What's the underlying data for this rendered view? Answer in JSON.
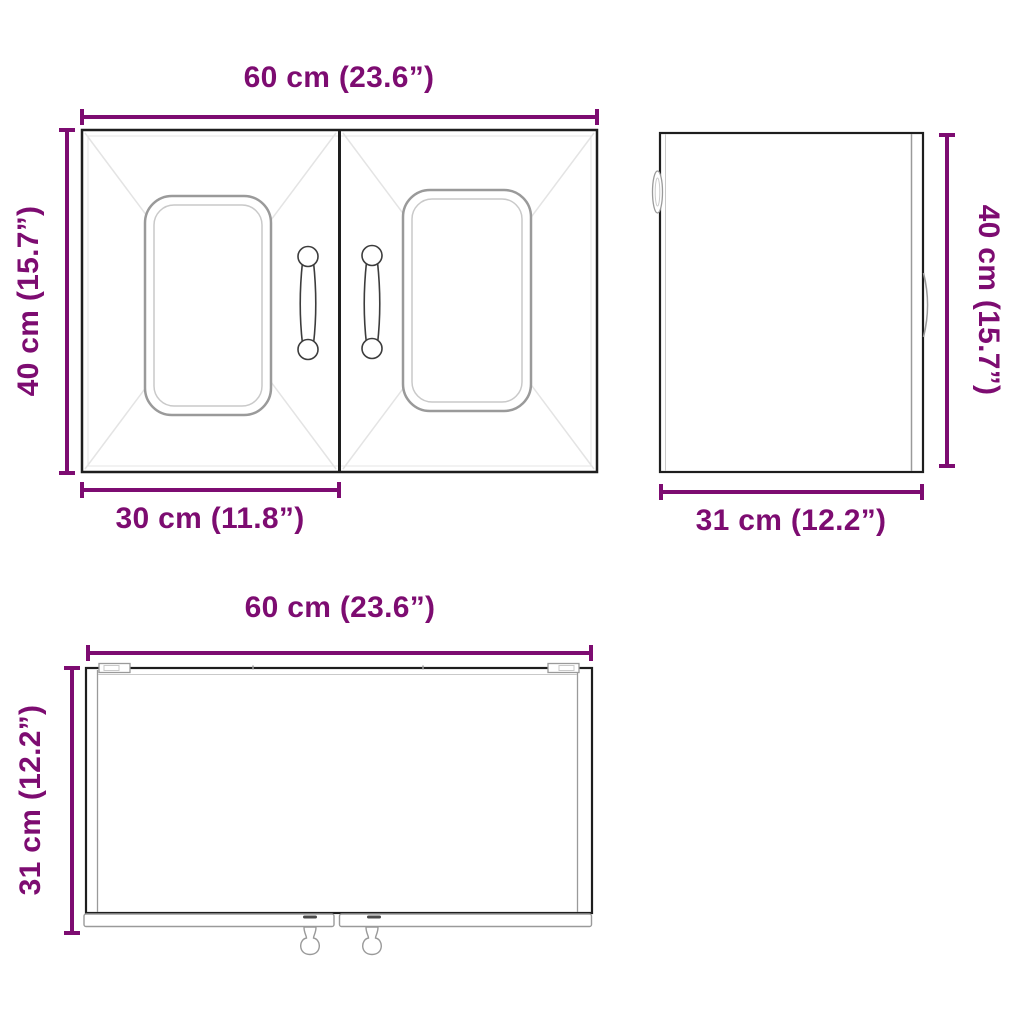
{
  "colors": {
    "dimension": "#7d0c71",
    "outline": "#1e1e1e",
    "detail": "#9a9a9a"
  },
  "views": {
    "front": {
      "width_label": "60 cm (23.6”)",
      "height_label": "40 cm (15.7”)",
      "door_width_label": "30 cm (11.8”)"
    },
    "side": {
      "height_label": "40 cm (15.7”)",
      "depth_label": "31 cm (12.2”)"
    },
    "top": {
      "width_label": "60 cm (23.6”)",
      "depth_label": "31 cm (12.2”)"
    }
  }
}
